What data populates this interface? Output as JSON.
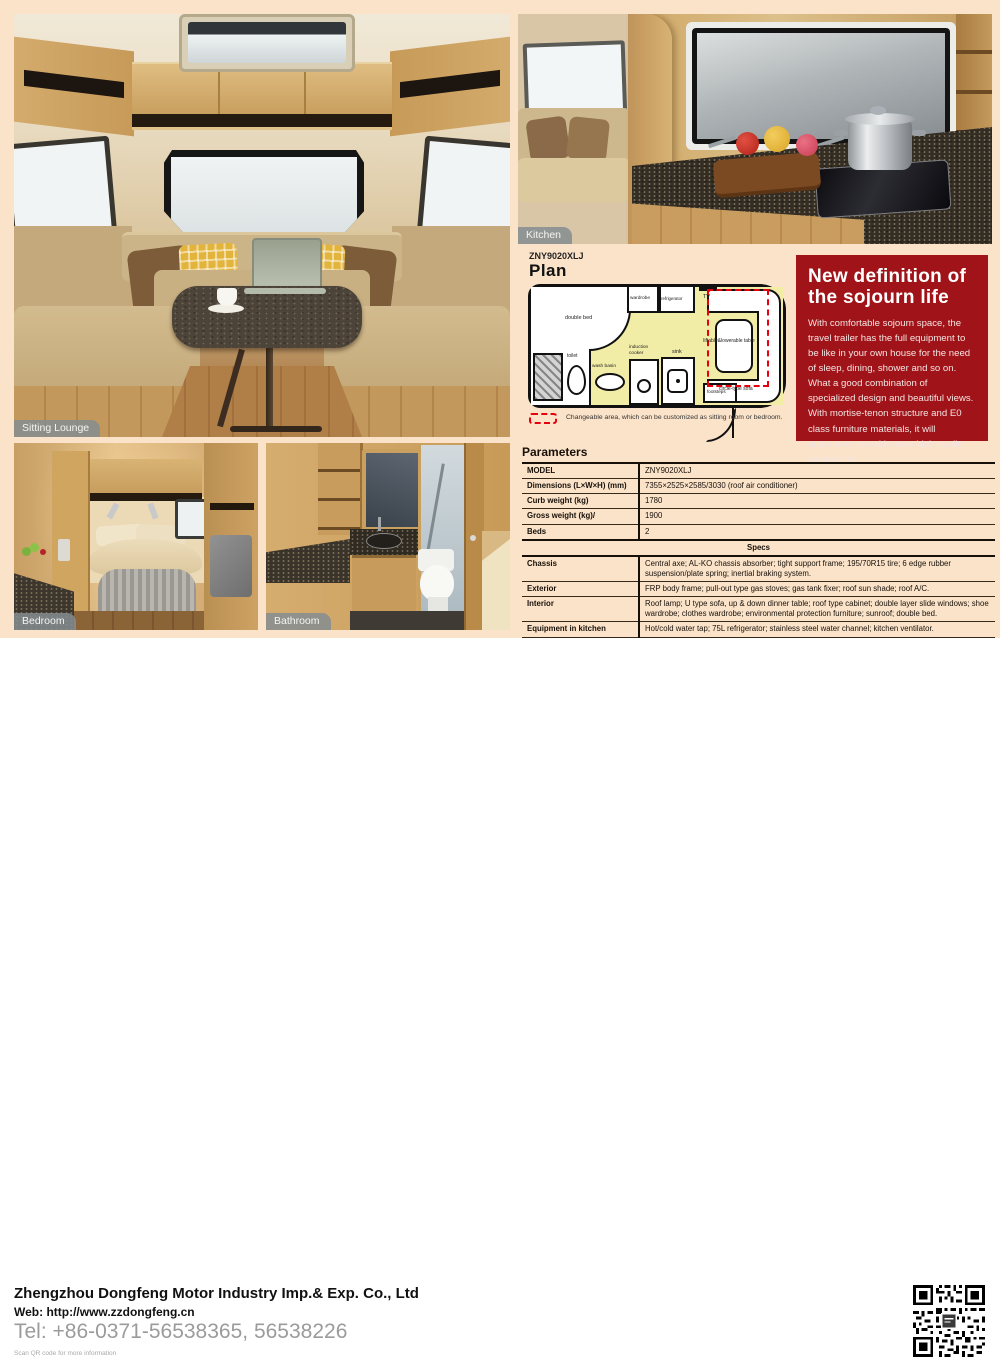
{
  "theme": {
    "page_bg": "#fbe3ca",
    "promo_red": "#a01419",
    "plan_floor_yellow": "#f2eda6",
    "changeable_dash_red": "#e8000f",
    "badge_gray": "#858d90"
  },
  "photos": {
    "sitting_lounge": {
      "label": "Sitting Lounge"
    },
    "kitchen": {
      "label": "Kitchen"
    },
    "bedroom": {
      "label": "Bedroom"
    },
    "bathroom": {
      "label": "Bathroom"
    }
  },
  "plan": {
    "model": "ZNY9020XLJ",
    "title": "Plan",
    "labels": {
      "double_bed": "double bed",
      "wardrobe": "wardrobe",
      "refrigerator": "refrigerator",
      "tv": "TV",
      "toilet": "toilet",
      "wash_basin": "wash basin",
      "induction_cooker": "induction cooker",
      "sink": "sink",
      "footsteps": "footsteps",
      "table": "liftable&lowerable table",
      "sofa": "circle-type sofa"
    },
    "legend": "Changeable area, which can be customized as sitting room or bedroom."
  },
  "promo": {
    "title_line1": "New definition of",
    "title_line2": "the sojourn life",
    "body": "With comfortable sojourn space, the travel trailer has the full equipment to be like in your own house for the need of sleep, dining, shower and so on. What a good combination of specialized design and beautiful views. With mortise-tenon structure and E0 class furniture materials, it will guarantee you with more high quality sojourn life."
  },
  "parameters": {
    "heading": "Parameters",
    "rows": [
      {
        "label": "MODEL",
        "value": "ZNY9020XLJ"
      },
      {
        "label": "Dimensions (L×W×H)  (mm)",
        "value": "7355×2525×2585/3030 (roof air conditioner)"
      },
      {
        "label": "Curb weight (kg)",
        "value": "1780"
      },
      {
        "label": "Gross weight (kg)/",
        "value": "1900"
      },
      {
        "label": "Beds",
        "value": "2"
      }
    ],
    "specs_header": "Specs",
    "specs": [
      {
        "label": "Chassis",
        "value": "Central axe; AL-KO chassis absorber; tight support frame; 195/70R15 tire; 6 edge rubber suspension/plate spring; inertial braking system."
      },
      {
        "label": "Exterior",
        "value": "FRP body frame; pull-out type gas stoves; gas tank fixer; roof sun shade; roof A/C."
      },
      {
        "label": "Interior",
        "value": "Roof lamp; U type sofa, up & down dinner table; roof type cabinet; double layer slide windows; shoe wardrobe; clothes wardrobe; environmental protection furniture; sunroof; double bed."
      },
      {
        "label": "Equipment in kitchen",
        "value": "Hot/cold water tap; 75L refrigerator; stainless steel water channel; kitchen ventilator."
      },
      {
        "label": "Water supply & bathroom",
        "value": "environmental protection material; rotatable stool; independent bathroom; wash stand; outside shower;80L water cleaning tank; specialized water pump; gravity water input."
      },
      {
        "label": "Electrics",
        "value": "Electricity connector; 12V cable; 220V charger; touch type control board; DVD system; 19 inch LCD TV."
      }
    ]
  },
  "footer": {
    "company": "Zhengzhou Dongfeng Motor Industry Imp.& Exp. Co., Ltd",
    "web": "Web: http://www.zzdongfeng.cn",
    "tel": "Tel: +86-0371-56538365, 56538226",
    "qr_note": "Scan QR code for more information"
  }
}
